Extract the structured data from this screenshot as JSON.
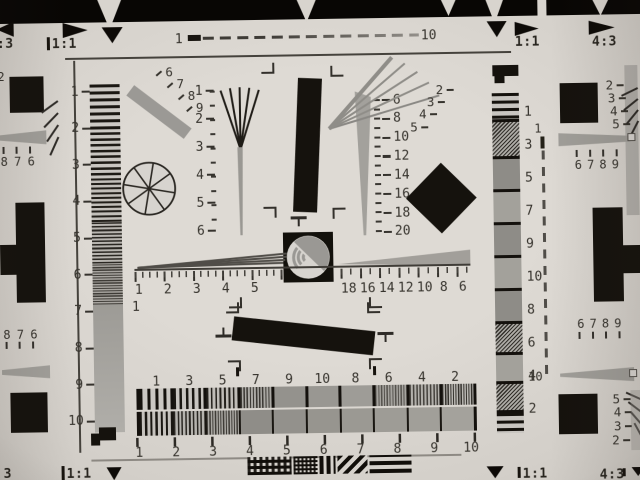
{
  "colors": {
    "paper": "#d8d4ce",
    "ink": "#15120d",
    "gray": "#9d9b96",
    "band": "#080604"
  },
  "top_edge": {
    "aspect_left_partial": ":3",
    "aspect_left": "1:1",
    "dash_start": "1",
    "dash_end": "10",
    "aspect_right": "1:1",
    "aspect_right2": "4:3"
  },
  "bottom_edge": {
    "aspect_left_partial": "3",
    "aspect_left": "1:1",
    "aspect_right": "1:1",
    "aspect_right2": "4:3"
  },
  "left_strip": {
    "numbers": [
      "1",
      "2",
      "3",
      "4",
      "5",
      "6",
      "7",
      "8",
      "9",
      "10"
    ]
  },
  "right_strip": {
    "numbers": [
      "1",
      "3",
      "5",
      "7",
      "9",
      "10",
      "8",
      "6",
      "4",
      "2"
    ]
  },
  "center": {
    "wedge_scale_small": [
      "1",
      "2",
      "3",
      "4",
      "5",
      "6"
    ],
    "wedge_scale_large": [
      "6",
      "8",
      "10",
      "12",
      "14",
      "16",
      "18",
      "20"
    ],
    "fan_nw": [
      "6",
      "7",
      "8",
      "9"
    ],
    "fan_ne": [
      "2",
      "3",
      "4",
      "5"
    ],
    "hscale_left": [
      "1",
      "2",
      "3",
      "4",
      "5"
    ],
    "hscale_left_origin": "1",
    "hscale_right": [
      "18",
      "16",
      "14",
      "12",
      "10",
      "8",
      "6"
    ],
    "burst_scale_outer": [
      "1",
      "3",
      "5",
      "7",
      "9",
      "10",
      "8",
      "6",
      "4",
      "2"
    ],
    "burst_scale_inner": [
      "1",
      "2",
      "3",
      "4",
      "5",
      "6",
      "7",
      "8",
      "9",
      "10"
    ]
  },
  "right_dash_scale": {
    "top": "1",
    "bottom": "10"
  },
  "left_edge": {
    "partial_number": "2",
    "numbers_top": [
      "8",
      "7",
      "6"
    ],
    "numbers_bottom": [
      "8",
      "7",
      "6"
    ]
  },
  "right_edge": {
    "fan_top": [
      "2",
      "3",
      "4",
      "5"
    ],
    "numbers_top": [
      "6",
      "7",
      "8",
      "9"
    ],
    "numbers_bottom": [
      "6",
      "7",
      "8",
      "9"
    ],
    "fan_bottom": [
      "5",
      "4",
      "3",
      "2"
    ]
  }
}
